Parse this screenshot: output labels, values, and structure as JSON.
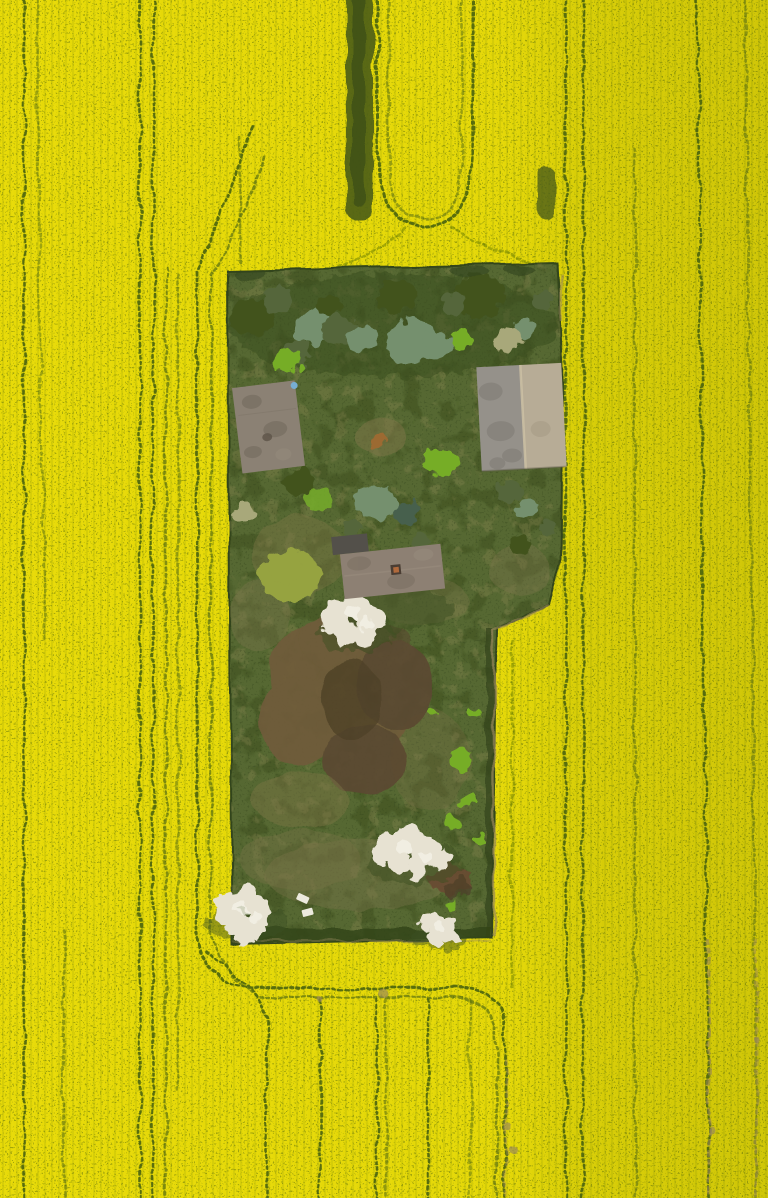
{
  "meta": {
    "title": "Aerial top-down drone photograph: lone overgrown farmstead plot inside a blooming yellow rapeseed field",
    "domain": "Natural-Image",
    "view": "orthogonal top-down",
    "dimensions": {
      "width": 768,
      "height": 1198
    }
  },
  "scene": {
    "field": {
      "label": "rapeseed field in full bloom",
      "description": "uniform bright-yellow canola bloom with fine seeding-row striations and dark-green tractor tramlines running vertically"
    },
    "tramlines": {
      "label": "tractor tramlines",
      "description": "paired wheel tracks; a U-turn loop above the plot, a headland ring curving around the plot, and a horizontal connector with turn-ins below it; lines at lower right fade to bare tan soil",
      "u_turn_location": "top centre",
      "connector_location": "below plot"
    },
    "plot": {
      "label": "overgrown farmstead enclave",
      "shape": "tall rectangle with a step cut into the right side below the east barn",
      "description": "green grass plot with dense tree row along the north edge, bare brown dug patch in the lower-left middle, bright shrubs along the east side, hedge along the south edge"
    },
    "buildings": [
      {
        "id": "barn-west",
        "roof": "weathered brown-grey hip roof, slightly rotated",
        "detail": "small blue barrel at north-east corner"
      },
      {
        "id": "barn-east",
        "roof": "large two-tone gable roof, dark west slope / pale east slope with central ridge"
      },
      {
        "id": "shed-central",
        "roof": "brown-grey roof with brick chimney and small dark annex at west end"
      }
    ],
    "blossom_trees": [
      {
        "id": "blossom-central",
        "note": "white flowering tree south-west of central shed"
      },
      {
        "id": "blossom-south-east",
        "note": "broad white flowering tree in lower plot"
      },
      {
        "id": "blossom-south-west",
        "note": "white flowering tree overhanging plot corner into field"
      },
      {
        "id": "blossom-south",
        "note": "small white flowering tree near south hedge"
      }
    ],
    "ground_objects": [
      {
        "id": "white-debris-panels",
        "count": 2,
        "note": "two small white boards lying in grass near south-west corner"
      },
      {
        "id": "red-brown-shrub",
        "note": "leafless twiggy shrub beside south-east blossom tree"
      }
    ]
  },
  "colors": {
    "field": "#e7da08",
    "fieldSpeckle": "#5f7110",
    "stripGreen": "#4e5f17",
    "track": "#486310",
    "trackTan": "#9a8656",
    "dirt": "#97865c",
    "plotBase": "#566831",
    "plotBlotchDark": "#3c4e1d",
    "plotBlotchLight": "#8d8a55",
    "plotSpeckle": "#2f401a",
    "hedge": "#33451a",
    "treeDark": "#42521f",
    "treeOlive": "#54663a",
    "treeSage": "#74906e",
    "treeBright": "#76ad28",
    "treePale": "#a8a87a",
    "willow": "#96a341",
    "teal": "#47614d",
    "brown1": "#6f5c3a",
    "brown2": "#5c4930",
    "brownCore": "#4f3e29",
    "dryTan": "#7b7548",
    "shrubRed": "#6b4c30",
    "blossom": "#e7e2d2",
    "blossomHi": "#f4f1e6",
    "blossomShadow": "#3b4d1e",
    "roofWest": "#8b8174",
    "roofWestDark": "#6f6659",
    "roofEastL": "#95918a",
    "roofEastR": "#b7ac96",
    "ridge": "#cdc1a5",
    "roofMid": "#8d8073",
    "roofMidDark": "#796d60",
    "annex": "#53504a",
    "chimney": "#4a3d33",
    "chimneyCore": "#b06a3c",
    "blueBarrel": "#77aed2",
    "white": "#eceade"
  }
}
